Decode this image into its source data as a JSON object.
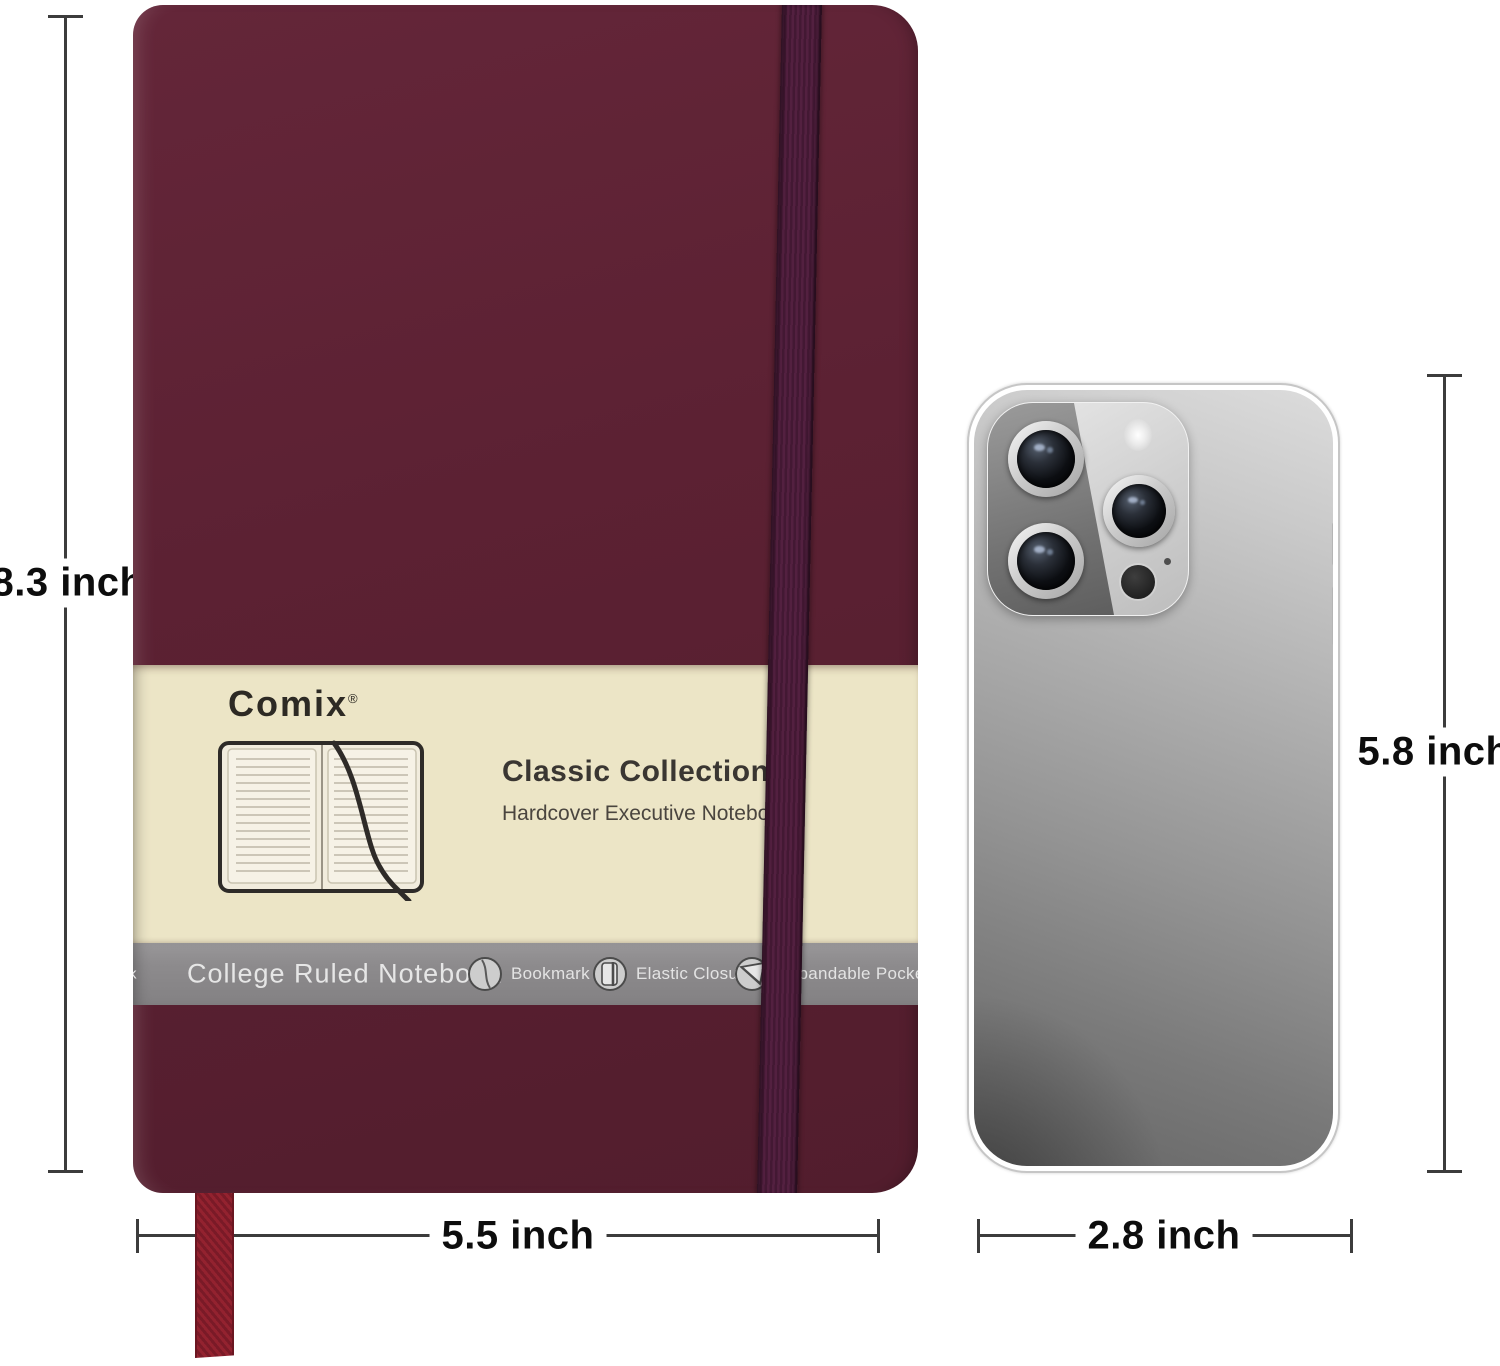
{
  "colors": {
    "cover": "#5c2133",
    "elastic": "#532040",
    "elastic-rib": "#431833",
    "ribbon": "#93222f",
    "ribbon-dark": "#7a1a27",
    "band-cream": "#ece5c6",
    "band-gray": "#8d8b8d",
    "band-gray-text": "#e6e6e6",
    "ink": "#2d2a24",
    "dim-line": "#3c3c3c",
    "dim-text": "#0d0d0d",
    "phone-light": "#dcdcdc",
    "phone-mid": "#949494",
    "phone-dark": "#656565"
  },
  "dimensions": {
    "notebook_height": "8.3 inch",
    "notebook_width": "5.5 inch",
    "phone_height": "5.8 inch",
    "phone_width": "2.8 inch"
  },
  "notebook": {
    "brand": "Comix",
    "brand_mark": "®",
    "title": "Classic Collection",
    "subtitle": "Hardcover Executive Notebook",
    "band_label": "College Ruled Notebook",
    "band_label_fragment": "k",
    "features": [
      {
        "icon": "bookmark-icon",
        "label": "Bookmark"
      },
      {
        "icon": "elastic-closure-icon",
        "label": "Elastic Closure"
      },
      {
        "icon": "expandable-pocket-icon",
        "label": "Expandable Pocket"
      }
    ]
  }
}
